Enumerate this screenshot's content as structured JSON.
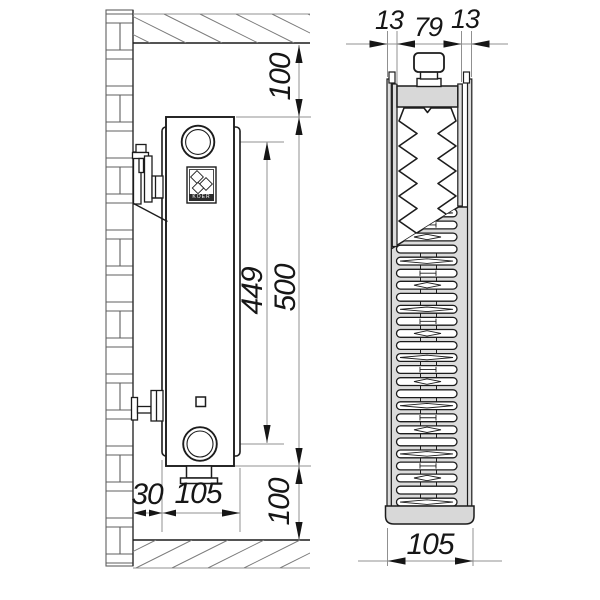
{
  "side_view": {
    "top_clearance": "100",
    "height": "500",
    "connection_spacing": "449",
    "bottom_clearance": "100",
    "wall_gap": "30",
    "depth": "105"
  },
  "section_view": {
    "front_panel": "13",
    "core": "79",
    "rear_panel": "13",
    "width": "105"
  },
  "logo": {
    "text": "KOER"
  },
  "colors": {
    "line": "#1c1c1c",
    "thin_line": "#909090",
    "gray_fill": "#d8d8d8",
    "plate_fill": "#dcdcdc",
    "background": "#ffffff"
  }
}
